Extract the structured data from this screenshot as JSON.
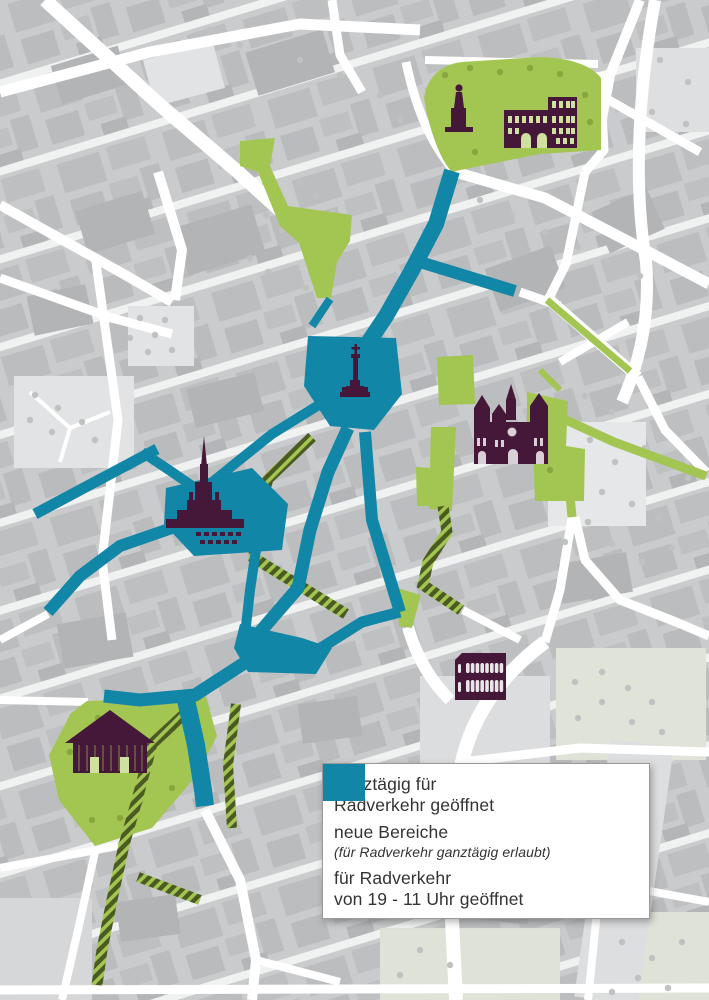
{
  "legend": {
    "items": [
      {
        "swatch": "solid-green",
        "line1": "ganztägig für",
        "line2": "Radverkehr geöffnet"
      },
      {
        "swatch": "hatched-green",
        "line1": "neue Bereiche",
        "line2": "(für Radverkehr ganztägig erlaubt)"
      },
      {
        "swatch": "solid-teal",
        "line1": "für Radverkehr",
        "line2": "von 19 - 11 Uhr geöffnet"
      }
    ]
  },
  "colors": {
    "open_all_day": "#a3c653",
    "new_area_dark": "#4b5a21",
    "open_19_11": "#1186a6",
    "landmark": "#451739"
  },
  "icons": [
    "statue-icon",
    "porta-nigra-icon",
    "cathedral-icon",
    "market-cross-icon",
    "fountain-icon",
    "roman-hall-icon",
    "amphitheater-icon"
  ]
}
